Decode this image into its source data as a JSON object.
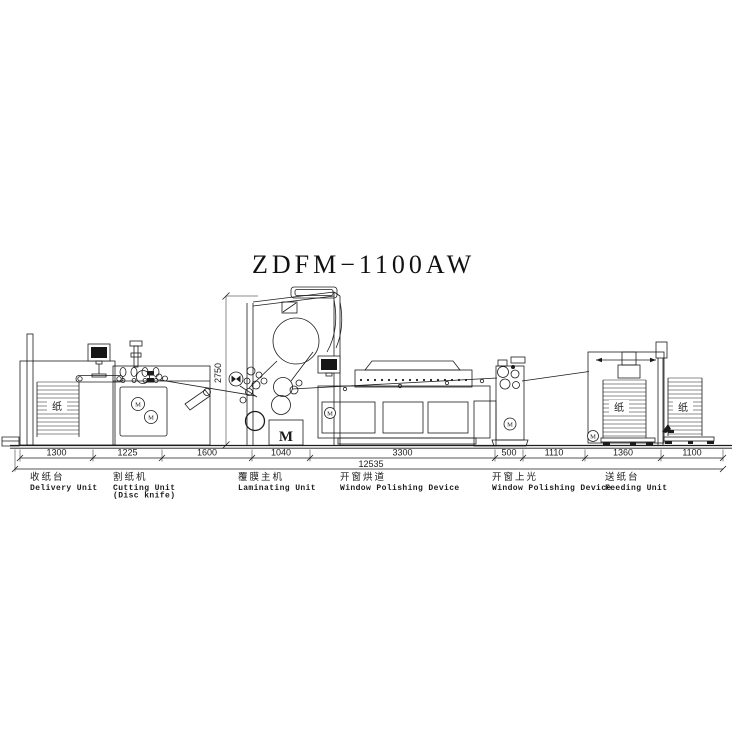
{
  "title": "ZDFM−1100AW",
  "dims": {
    "segments": [
      "1300",
      "1225",
      "1600",
      "1040",
      "3300",
      "500",
      "1110",
      "1360",
      "1100"
    ],
    "total": "12535",
    "height": "2750"
  },
  "labels": {
    "units": [
      {
        "zh": "收纸台",
        "en": "Delivery Unit",
        "en2": ""
      },
      {
        "zh": "割纸机",
        "en": "Cutting Unit",
        "en2": "(Disc knife)"
      },
      {
        "zh": "覆膜主机",
        "en": "Laminating Unit",
        "en2": ""
      },
      {
        "zh": "开窗烘道",
        "en": "Window Polishing Device",
        "en2": ""
      },
      {
        "zh": "开窗上光",
        "en": "Window Polishing Device",
        "en2": ""
      },
      {
        "zh": "送纸台",
        "en": "Feeding Unit",
        "en2": ""
      }
    ],
    "paper": "纸",
    "motor": "M"
  },
  "colors": {
    "line": "#1c1c1c",
    "background": "#ffffff"
  }
}
